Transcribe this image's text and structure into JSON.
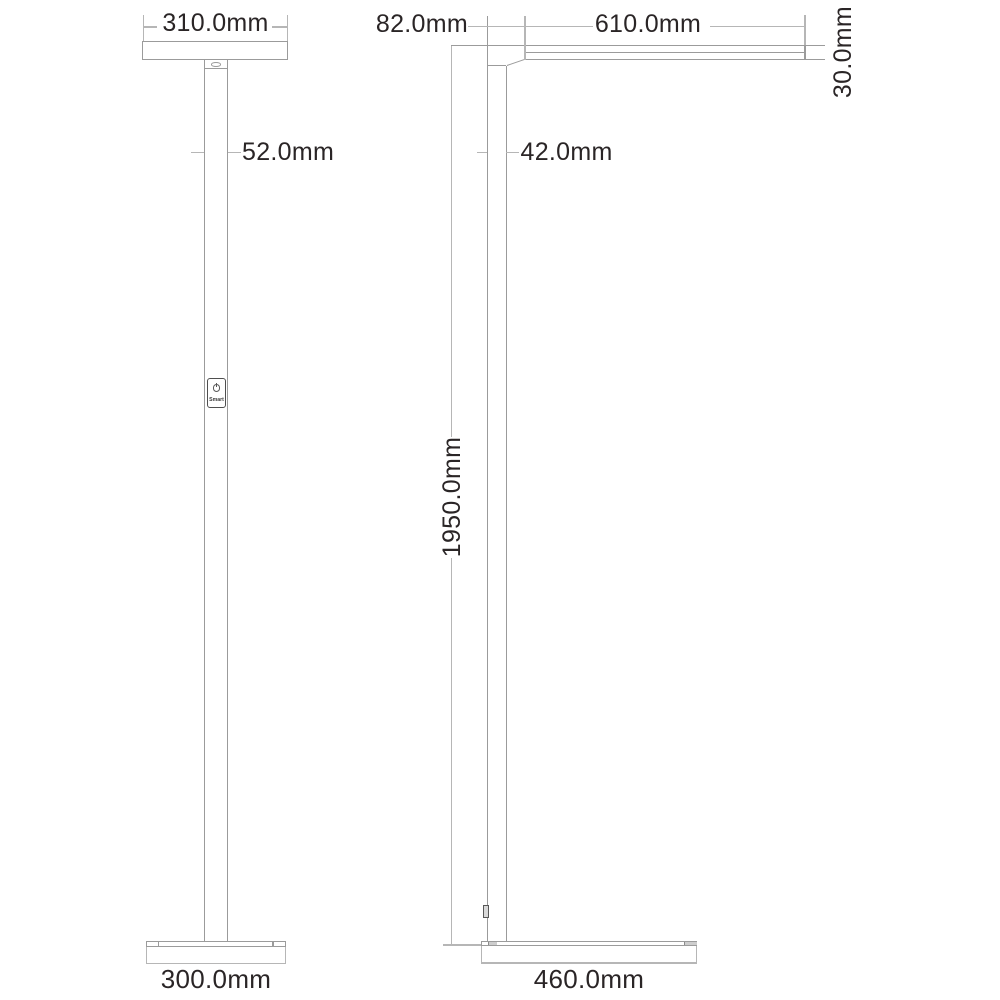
{
  "front": {
    "head_width": "310.0mm",
    "pole_width": "52.0mm",
    "base_width": "300.0mm",
    "switch": {
      "label": "Smart",
      "icon": "power-icon"
    }
  },
  "side": {
    "head_offset": "82.0mm",
    "arm_length": "610.0mm",
    "head_thickness": "30.0mm",
    "pole_depth": "42.0mm",
    "total_height": "1950.0mm",
    "base_depth": "460.0mm"
  },
  "colors": {
    "geometry_line": "#9b9b9b",
    "dimension_line": "#b6b6b6",
    "detail_line": "#4f4f4f",
    "text": "#2a2526",
    "background": "#ffffff"
  }
}
